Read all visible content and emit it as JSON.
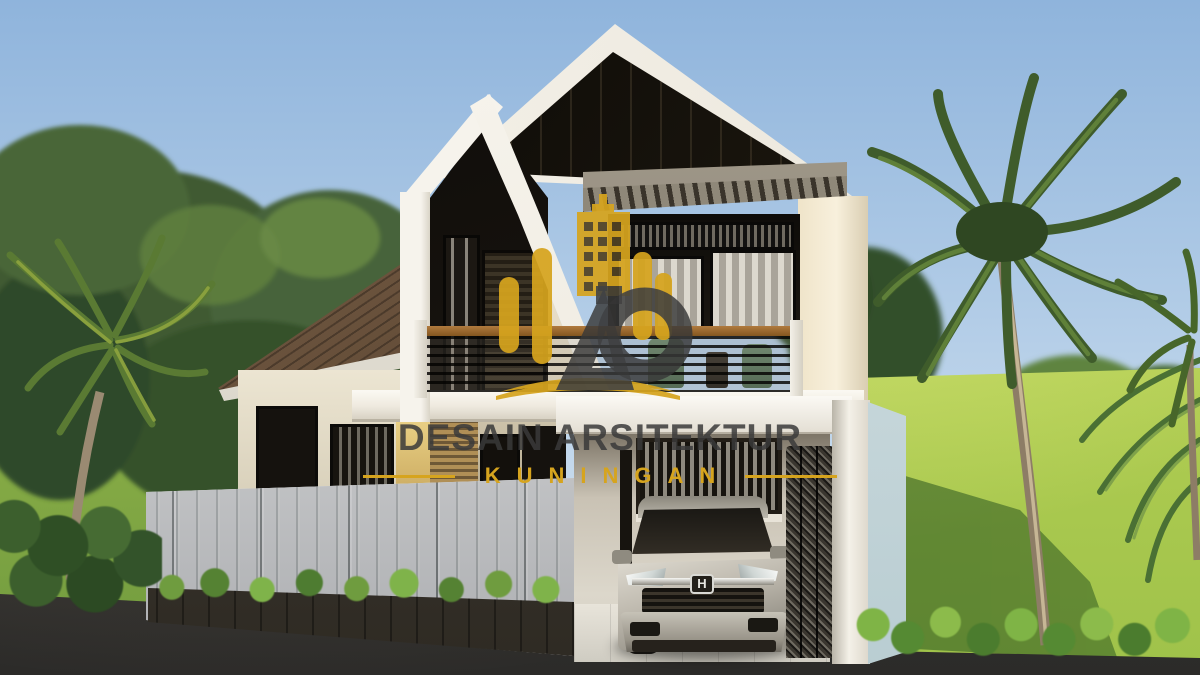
{
  "watermark": {
    "title": "DESAIN ARSITEKTUR",
    "subtitle": "KUNINGAN",
    "logo_monogram": "DA",
    "logo_icon": "gold-building-skyline",
    "gold": "#D6A41E",
    "title_color": "rgba(58,58,58,0.85)"
  },
  "scene": {
    "type": "3d-architectural-exterior-render",
    "subject": "modern two-story house with twin gable roofs, balcony, carport and folding gate",
    "car": {
      "color": "silver",
      "emblem": "H"
    },
    "elements": [
      "sky",
      "trees",
      "palm-trees",
      "lawn",
      "asphalt-road",
      "white-fence",
      "planter-shrubs",
      "carport",
      "suv-car",
      "folding-gate",
      "balcony-railing",
      "pergola",
      "shingle-roof",
      "black-panel-gable",
      "curtained-windows",
      "balcony-chairs"
    ]
  },
  "palette": {
    "sky": "#9ABFE2",
    "wall_white": "#F2EFE8",
    "wall_cream": "#ECE5D2",
    "roof_brown": "#5D4733",
    "panel_black": "#16120D",
    "pergola_gray": "#8F8879",
    "lawn_green": "#B9D054",
    "lawn_shadow": "#3F6B2E",
    "road_asphalt": "#3A3835",
    "fence_gray": "#DFE1DF",
    "wood_rail": "#9A6838",
    "car_silver": "#C9C5BA",
    "gate_dark": "#37332D",
    "side_wall_blue": "#C9D9DC",
    "accent_gold": "#D6A41E"
  }
}
